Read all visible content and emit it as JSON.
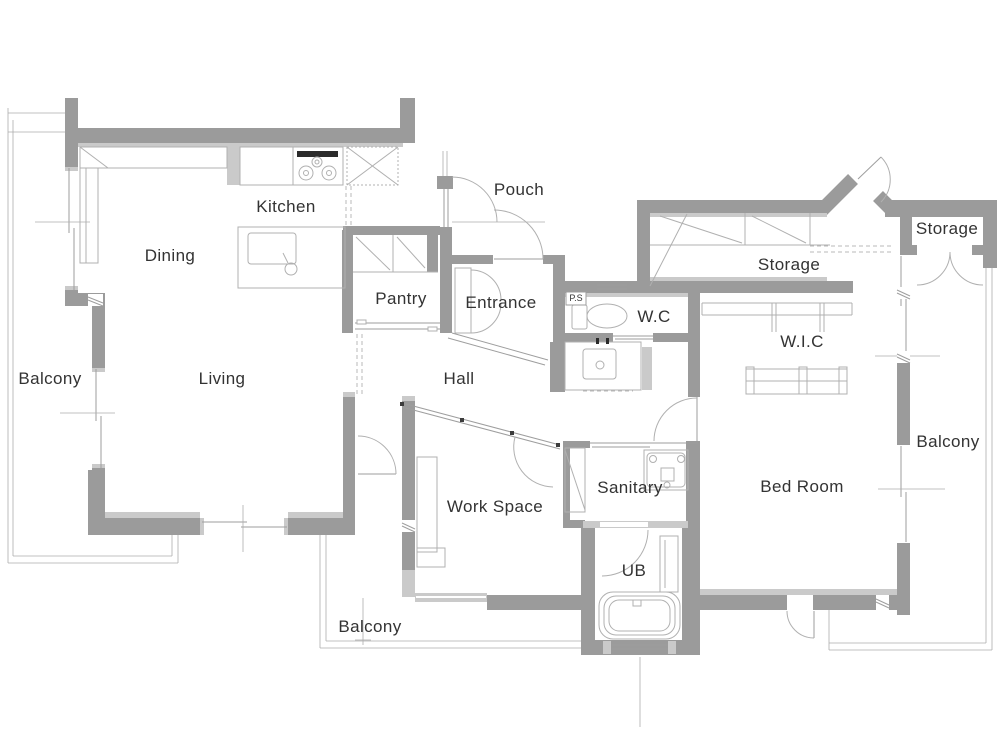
{
  "plan": {
    "rooms": {
      "dining": "Dining",
      "kitchen": "Kitchen",
      "pantry": "Pantry",
      "pouch": "Pouch",
      "entrance": "Entrance",
      "hall": "Hall",
      "living": "Living",
      "wc": "W.C",
      "ps": "P.S",
      "storage_main": "Storage",
      "storage_small": "Storage",
      "wic": "W.I.C",
      "bedroom": "Bed Room",
      "sanitary": "Sanitary",
      "ub": "UB",
      "work_space": "Work Space",
      "balcony_left": "Balcony",
      "balcony_bottom": "Balcony",
      "balcony_right": "Balcony"
    },
    "colors": {
      "wall": "#9b9b9b",
      "wall_light": "#cacaca",
      "line": "#9e9e9e",
      "fixture_line": "#b0b0b0",
      "text": "#333333",
      "background": "#ffffff"
    },
    "fixtures": [
      "gas-stove",
      "kitchen-sink",
      "island-counter",
      "refrigerator-space",
      "toilet",
      "washbasin",
      "washing-machine",
      "bathtub",
      "desk",
      "closet-shelves",
      "hanging-rods"
    ]
  }
}
